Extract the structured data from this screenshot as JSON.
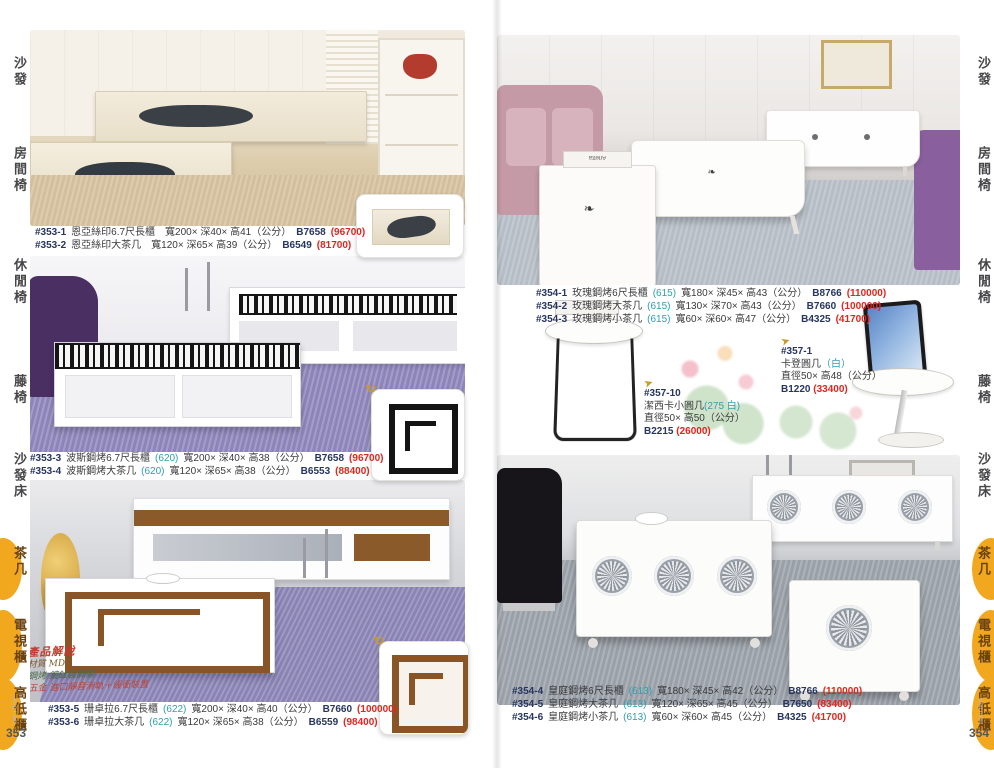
{
  "page": {
    "left_number": "353",
    "right_number": "354",
    "watermark": "king room"
  },
  "tabs": [
    {
      "label": "沙發",
      "active": false
    },
    {
      "label": "房間椅",
      "active": false
    },
    {
      "label": "休閒椅",
      "active": false
    },
    {
      "label": "藤椅",
      "active": false
    },
    {
      "label": "沙發床",
      "active": false
    },
    {
      "label": "茶几",
      "active": true
    },
    {
      "label": "電視櫃",
      "active": true
    },
    {
      "label": "高低櫃",
      "active": true
    }
  ],
  "colors": {
    "tab_highlight": "#f2a81e",
    "price_red": "#e0251d",
    "variant_teal": "#2f9fae",
    "code_navy": "#27355f"
  },
  "left_page": {
    "groups": [
      {
        "rows": [
          {
            "model": "#353-1",
            "name": "恩亞絲印6.7尺長櫃",
            "variant": "",
            "dims": "寬200× 深40× 高41（公分）",
            "code": "B7658",
            "price": "(96700)"
          },
          {
            "model": "#353-2",
            "name": "恩亞絲印大茶几",
            "variant": "",
            "dims": "寬120× 深65× 高39（公分）",
            "code": "B6549",
            "price": "(81700)"
          }
        ]
      },
      {
        "rows": [
          {
            "model": "#353-3",
            "name": "波斯鋼烤6.7尺長櫃",
            "variant": "(620)",
            "dims": "寬200× 深40× 高38（公分）",
            "code": "B7658",
            "price": "(96700)"
          },
          {
            "model": "#353-4",
            "name": "波斯鋼烤大茶几",
            "variant": "(620)",
            "dims": "寬120× 深65× 高38（公分）",
            "code": "B6553",
            "price": "(88400)"
          }
        ]
      },
      {
        "rows": [
          {
            "model": "#353-5",
            "name": "珊卓拉6.7尺長櫃",
            "variant": "(622)",
            "dims": "寬200× 深40× 高40（公分）",
            "code": "B7660",
            "price": "(100000)"
          },
          {
            "model": "#353-6",
            "name": "珊卓拉大茶几",
            "variant": "(622)",
            "dims": "寬120× 深65× 高38（公分）",
            "code": "B6559",
            "price": "(98400)"
          }
        ]
      }
    ],
    "script_note": {
      "title": "產品解說",
      "line1": "材質 MDF",
      "line2": "鋼烤 鍍鈦裝飾條",
      "line3": "五金 進口靜音滑軌＋緩衝裝置"
    }
  },
  "right_page": {
    "groups": [
      {
        "rows": [
          {
            "model": "#354-1",
            "name": "玫瑰鋼烤6尺長櫃",
            "variant": "(615)",
            "dims": "寬180× 深45× 高43（公分）",
            "code": "B8766",
            "price": "(110000)"
          },
          {
            "model": "#354-2",
            "name": "玫瑰鋼烤大茶几",
            "variant": "(615)",
            "dims": "寬130× 深70× 高43（公分）",
            "code": "B7660",
            "price": "(100000)"
          },
          {
            "model": "#354-3",
            "name": "玫瑰鋼烤小茶几",
            "variant": "(615)",
            "dims": "寬60× 深60× 高47（公分）",
            "code": "B4325",
            "price": "(41700)"
          }
        ]
      },
      {
        "rows": [
          {
            "model": "#354-4",
            "name": "皇庭鋼烤6尺長櫃",
            "variant": "(613)",
            "dims": "寬180× 深45× 高42（公分）",
            "code": "B8766",
            "price": "(110000)"
          },
          {
            "model": "#354-5",
            "name": "皇庭鋼烤大茶几",
            "variant": "(613)",
            "dims": "寬120× 深65× 高45（公分）",
            "code": "B7650",
            "price": "(83400)"
          },
          {
            "model": "#354-6",
            "name": "皇庭鋼烤小茶几",
            "variant": "(613)",
            "dims": "寬60× 深60× 高45（公分）",
            "code": "B4325",
            "price": "(41700)"
          }
        ]
      }
    ],
    "side_items": [
      {
        "arrow": "➤",
        "model": "#357-10",
        "name": "潔西卡小圓几",
        "variant": "(275 白)",
        "dims": "直徑50× 高50（公分）",
        "code": "B2215",
        "price": "(26000)"
      },
      {
        "arrow": "➤",
        "model": "#357-1",
        "name": "卡登圓几",
        "variant": "（白）",
        "dims": "直徑50× 高48（公分）",
        "code": "B1220",
        "price": "(33400)"
      }
    ],
    "book_label": "Arletta"
  },
  "icons": {
    "swirl": "↻",
    "arrow": "➤"
  }
}
